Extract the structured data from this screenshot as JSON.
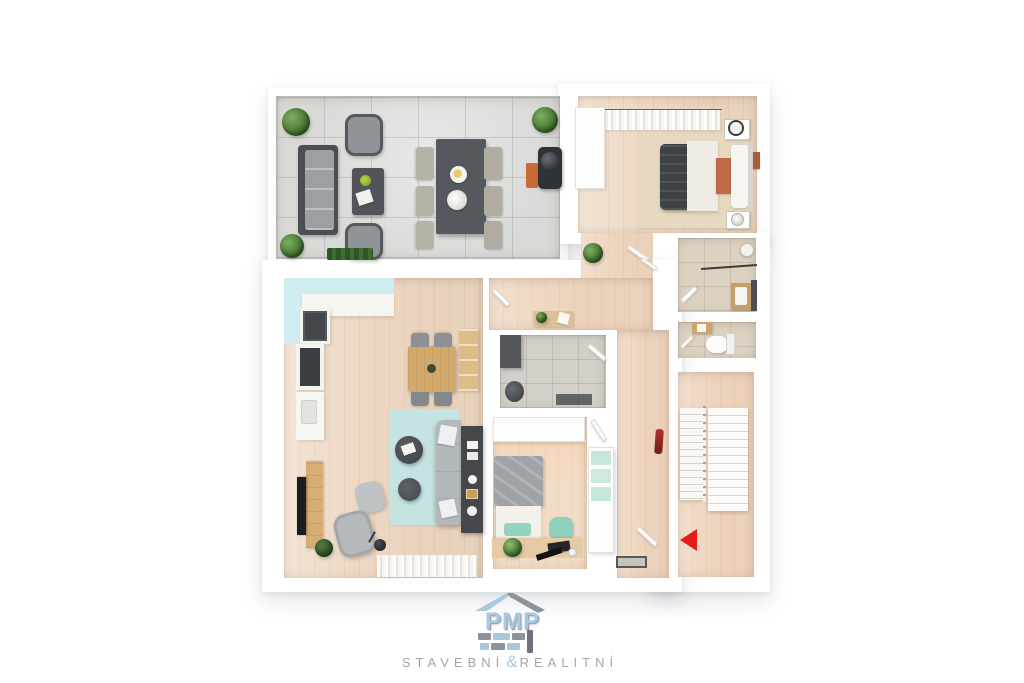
{
  "image": {
    "kind": "3d-floor-plan-render",
    "background": "#ffffff",
    "entrance_arrow": {
      "direction": "left",
      "color": "#e31c19"
    }
  },
  "logo": {
    "brand": "PMP",
    "tagline_left": "STAVEBNÍ",
    "tagline_amp": "&",
    "tagline_right": "REALITNÍ",
    "brand_color": "#a9c7dd",
    "accent_gray": "#8d939c",
    "tagline_color": "#a0a6ad"
  },
  "palette": {
    "walls": "#ffffff",
    "terrace_tile": "#d9d9d7",
    "wood_floor": "#eed9c5",
    "hall_wood": "#eed5bf",
    "kids_wood": "#f2dcc6",
    "bath_tile": "#ddd2c2",
    "utility_tile": "#d3d0c9",
    "kitchen_accent_cyan": "#cfecee",
    "rug_teal": "#c5e3e0",
    "kids_teal": "#93d3bf",
    "sofa_gray": "#b5b8bb",
    "dark_furniture": "#45474b",
    "wood_furniture": "#d3aa6d",
    "accent_orange": "#bf6a48",
    "arrow_red": "#e31c19"
  },
  "rooms": [
    {
      "id": "terrace"
    },
    {
      "id": "master-bedroom"
    },
    {
      "id": "hallway"
    },
    {
      "id": "bathroom"
    },
    {
      "id": "wc"
    },
    {
      "id": "utility-room"
    },
    {
      "id": "kids-bedroom"
    },
    {
      "id": "living-room-kitchen"
    },
    {
      "id": "staircase-hall"
    }
  ]
}
